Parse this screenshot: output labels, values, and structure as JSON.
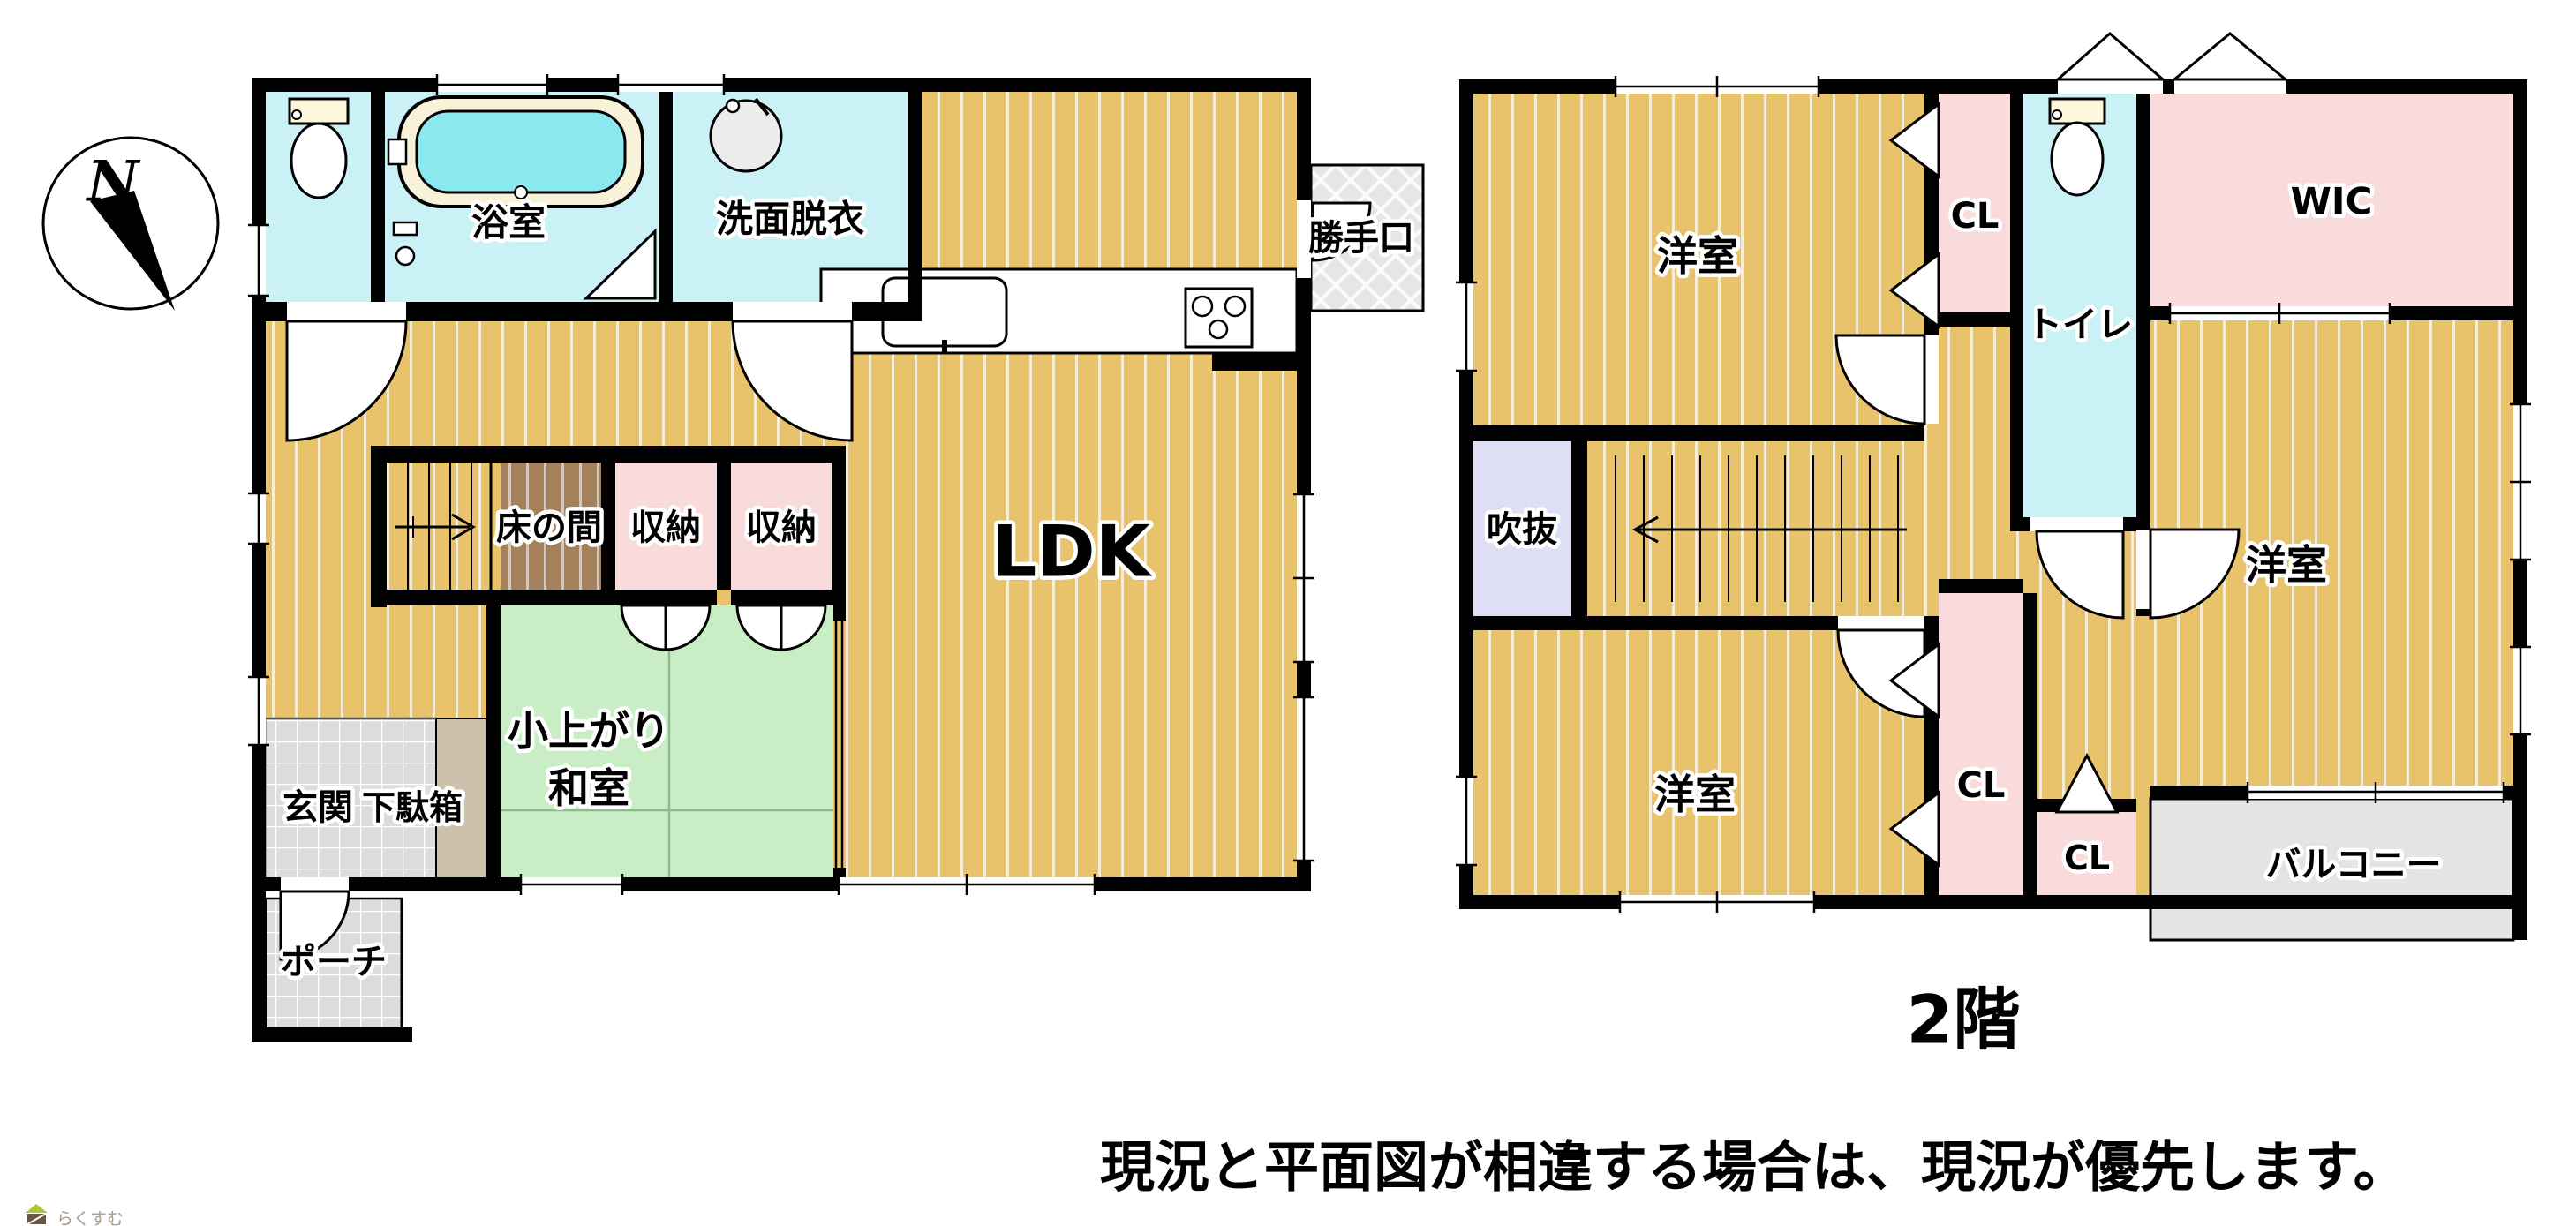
{
  "compass": {
    "letter": "N"
  },
  "floor1": {
    "toilet_room": "",
    "bath": "浴室",
    "washroom": "洗面脱衣",
    "kitchen_door": "勝手口",
    "ldk": "LDK",
    "tokonoma": "床の間",
    "storage_a": "収納",
    "storage_b": "収納",
    "tatami_line1": "小上がり",
    "tatami_line2": "和室",
    "entrance": "玄関",
    "shoe_cabinet": "下駄箱",
    "porch": "ポーチ"
  },
  "floor2": {
    "bedroom_nw": "洋室",
    "closet_top": "CL",
    "toilet": "トイレ",
    "wic": "WIC",
    "void_space": "吹抜",
    "bedroom_sw": "洋室",
    "bedroom_e": "洋室",
    "closet_tall": "CL",
    "closet_small": "CL",
    "balcony": "バルコニー",
    "caption": "2階"
  },
  "notes": {
    "disclaimer": "現況と平面図が相違する場合は、現況が優先します。"
  },
  "watermark": {
    "brand": "らくすむ"
  },
  "colors": {
    "wood": "#e9c36c",
    "cyan": "#c9f1f6",
    "pink": "#fadbdb",
    "green": "#c9eec6",
    "lavender": "#dedef5",
    "brown": "#a3815a",
    "tile": "#dcdcdc",
    "balcony_gray": "#e4e4e4",
    "wall": "#000000",
    "tub_water": "#8ce8ef"
  }
}
